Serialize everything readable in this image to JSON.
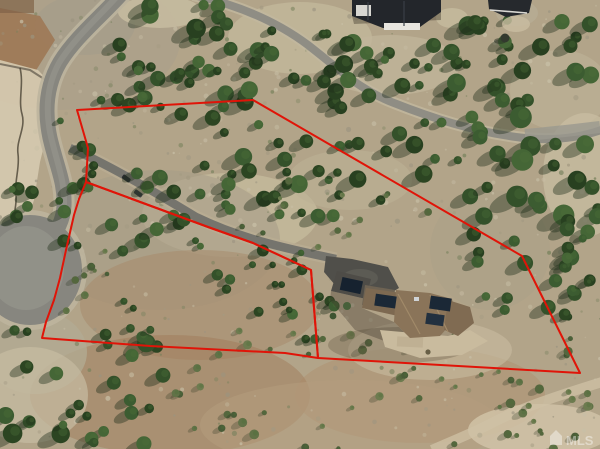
{
  "scene": {
    "type": "aerial-drone-photograph",
    "description": "Oblique aerial view of a sloped, tree-dotted mountain lot outlined in red, with a cul-de-sac street at left, a long driveway, a solar-roofed house on the lot, and neighboring homes along the top",
    "watermark": "MLS",
    "boundary_color": "#e01408",
    "boundary": {
      "upper_parcel": "77,110 253,100 522,256 580,373 318,358 311,270 253,243 208,227 86,182 88,148",
      "lower_parcel": "86,182 208,227 253,243 311,270 318,358 285,353 150,346 42,338 46,322 54,300 60,278 66,250 74,215 79,199"
    },
    "palette": {
      "dirt_base": "#b7a88d",
      "pale_dirt": "#d7cbb1",
      "red_dirt": "#a07a58",
      "asphalt_road": "#87867f",
      "asphalt_driveway": "#75746d",
      "dark_apron": "#504f4a",
      "pine_green": "#34512a",
      "subject_roof": "#8a7459",
      "neighbor_roof": "#23262b",
      "solar_panel": "#1b2836"
    }
  }
}
